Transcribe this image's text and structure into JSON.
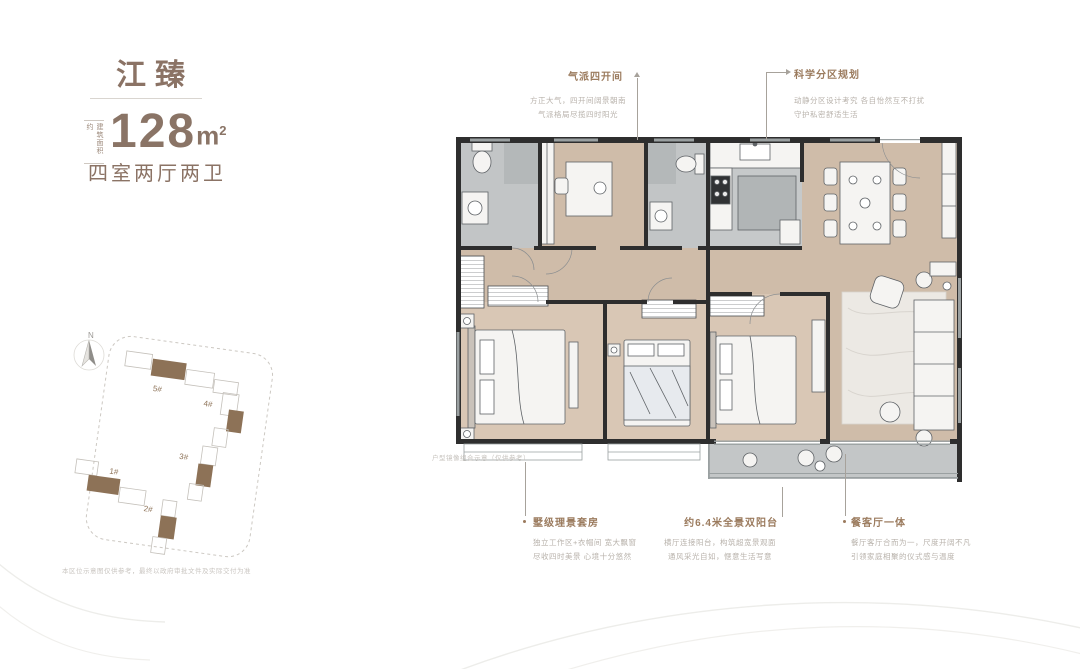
{
  "header": {
    "project_name": "江臻",
    "area_note": "建筑面积约",
    "area_value": "128",
    "area_unit": "m",
    "area_sup": "2",
    "layout": "四室两厅两卫"
  },
  "annotations": {
    "top_center": {
      "title": "气派四开间",
      "lines": [
        "方正大气，四开间阔景朝南",
        "气派格局尽揽四时阳光"
      ]
    },
    "top_right": {
      "title": "科学分区规划",
      "lines": [
        "动静分区设计考究 各自怡然互不打扰",
        "守护私密舒适生活"
      ]
    },
    "bottom_left": {
      "title": "墅级理景套房",
      "lines": [
        "独立工作区+衣帽间 宽大飘窗",
        "尽收四时美景 心境十分悠然"
      ]
    },
    "bottom_center": {
      "title": "约6.4米全景双阳台",
      "lines": [
        "横厅连接阳台，构筑超宽景观面",
        "通风采光自如，惬意生活写意"
      ]
    },
    "bottom_right": {
      "title": "餐客厅一体",
      "lines": [
        "餐厅客厅合而为一，尺度开阔不凡",
        "引领家庭相聚的仪式感与温度"
      ]
    }
  },
  "floorplan": {
    "note": "户型镜像组合示意（仅供参考）"
  },
  "siteplan": {
    "compass": "N",
    "buildings": [
      "1#",
      "2#",
      "3#",
      "4#",
      "5#"
    ],
    "disclaimer": "本区位示意图仅供参考，最终以政府审批文件及实际交付为准"
  },
  "colors": {
    "brand_brown": "#8b7365",
    "callout_brown": "#9b7b5e",
    "body_gray": "#b8b2ab",
    "wall_dark": "#2e2e2e",
    "window_gray": "#9aa0a1",
    "wood_floor": "#cfbca9",
    "bedroom_wood": "#d9c7b5",
    "tile_gray": "#c2c5c6",
    "site_brown": "#8d7257"
  }
}
